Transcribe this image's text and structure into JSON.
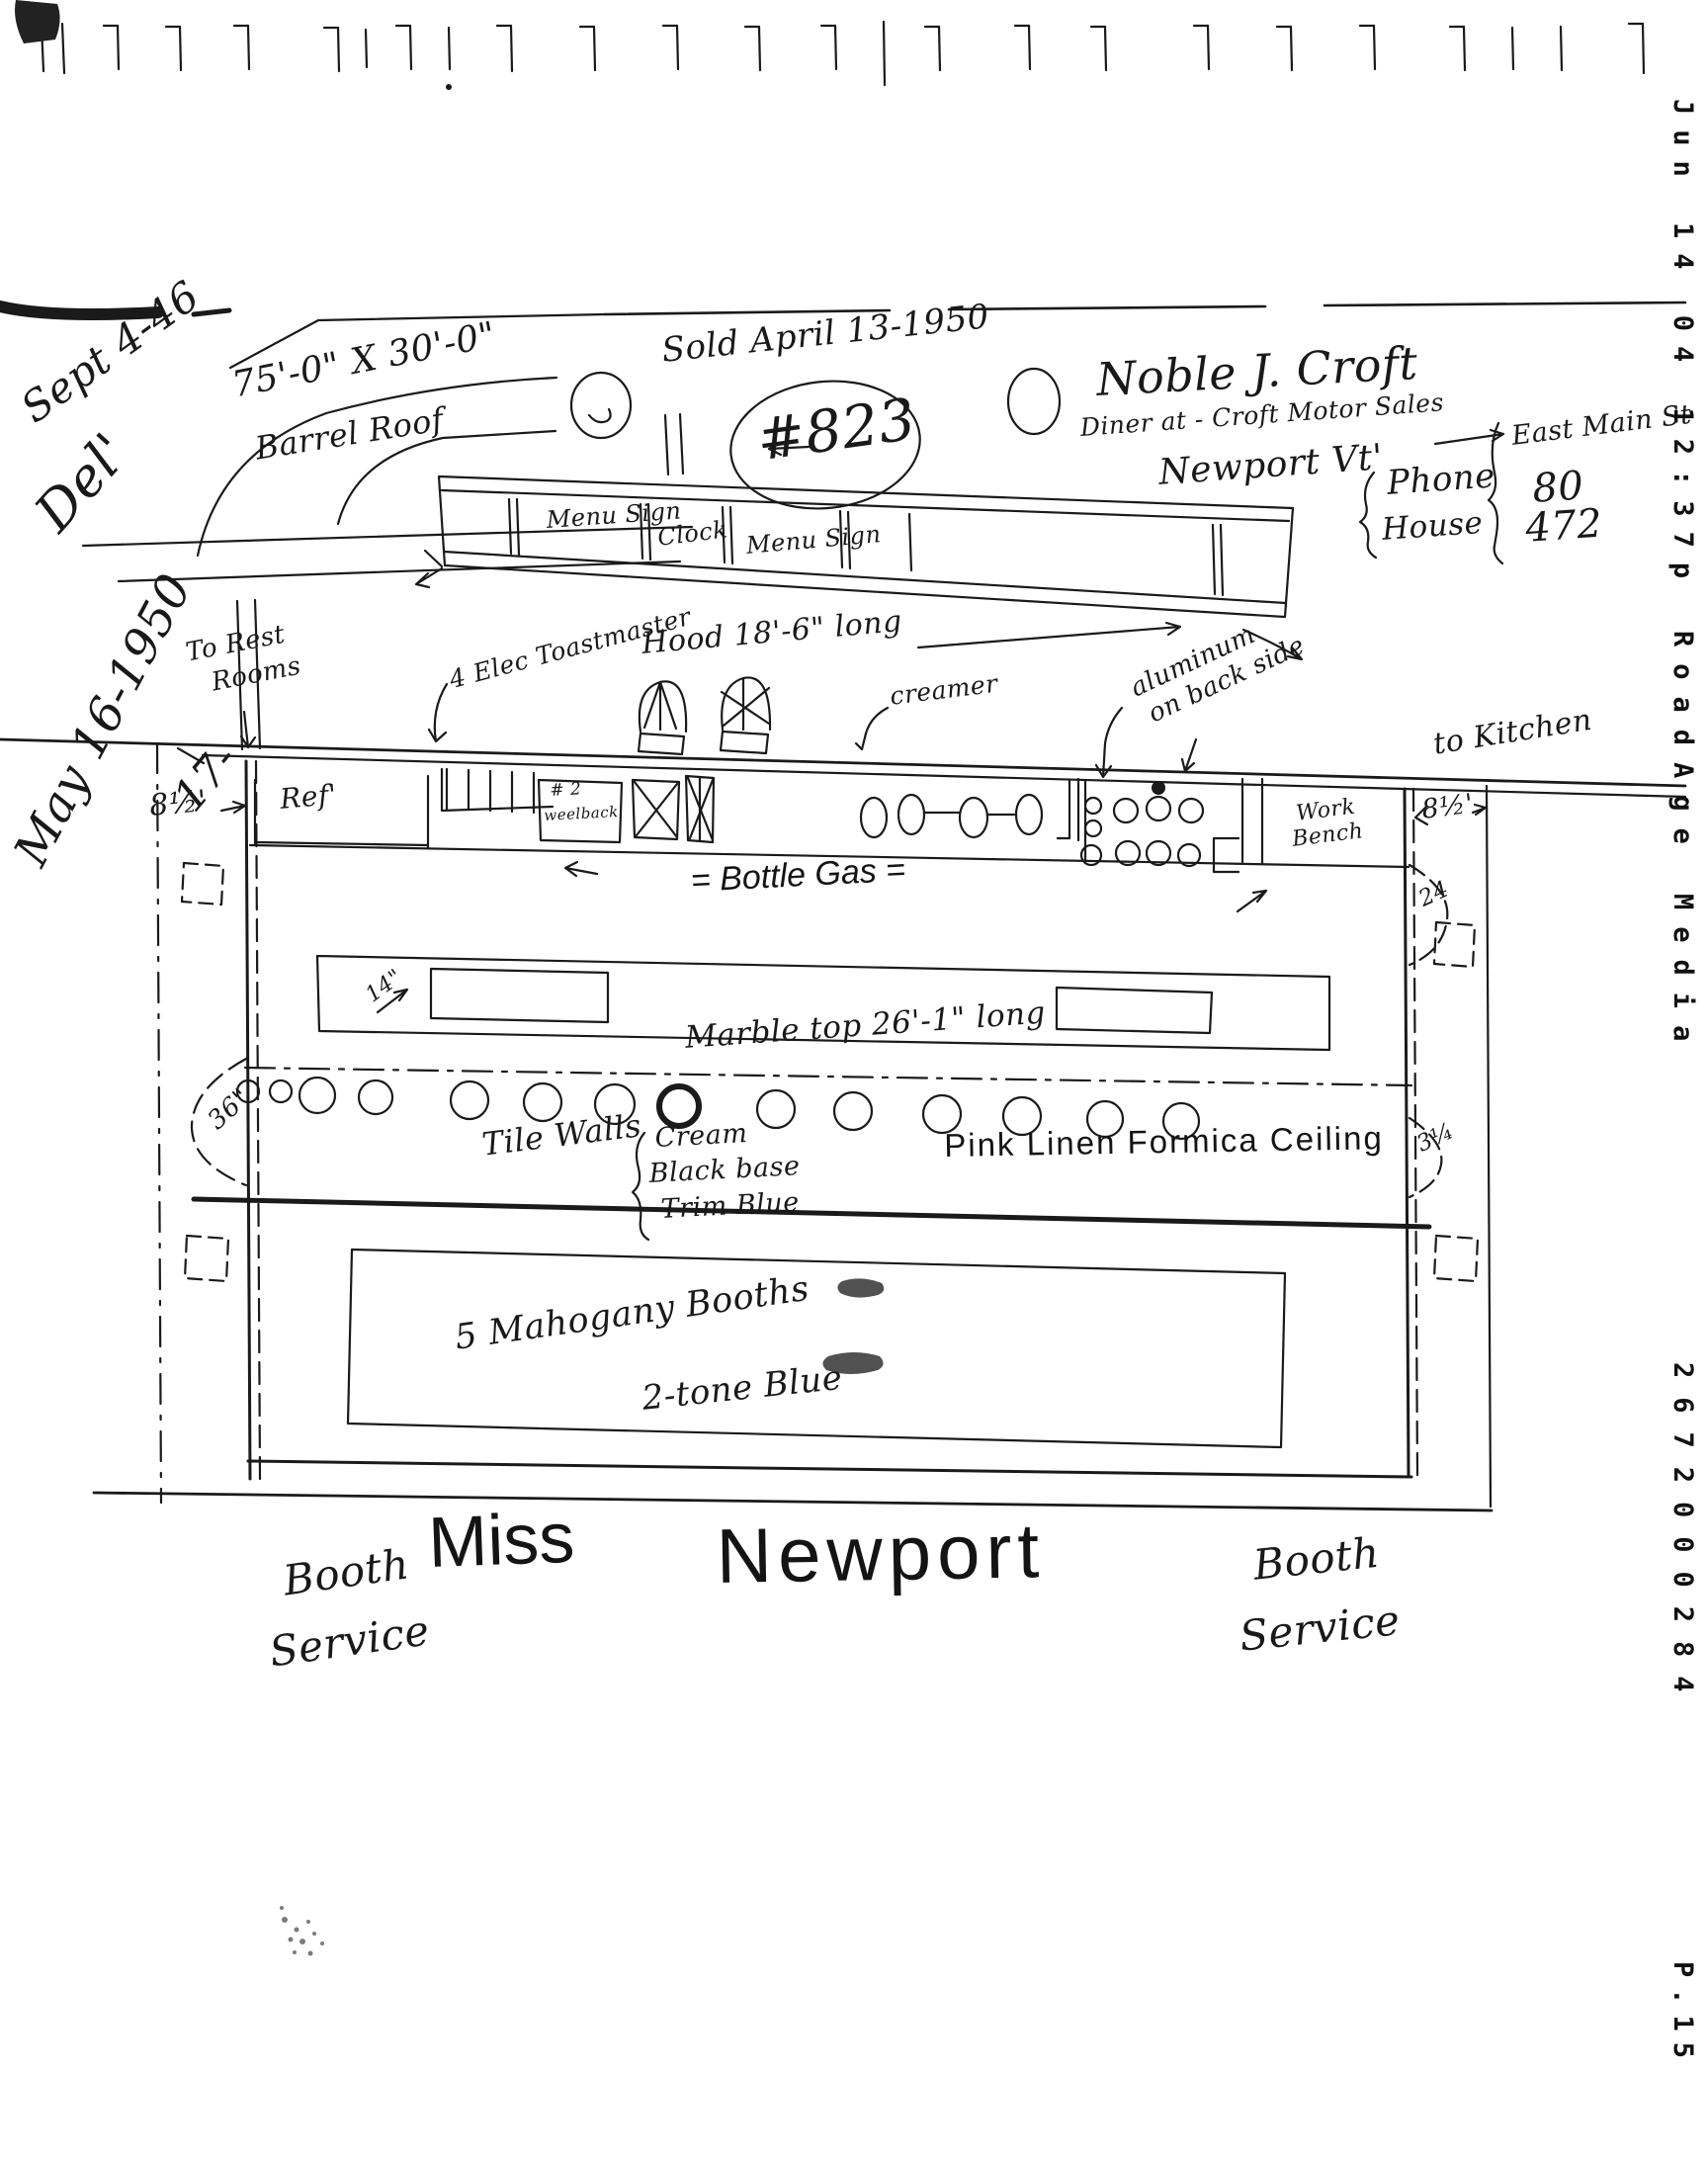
{
  "fax": {
    "datetime": "Jun 14 04 12:37p",
    "station": "RoadAge Media",
    "number": "2672000284",
    "page": "P.15"
  },
  "notes": {
    "top_left_date": "Sept 4-46",
    "del": "Del'",
    "may_date": "May 16-1950",
    "seventeen": "17-",
    "size": "75'-0\" X 30'-0\"",
    "roof": "Barrel Roof",
    "sold": "Sold April 13-1950",
    "car_number": "#823",
    "owner_name": "Noble J. Croft",
    "owner_line": "Diner at - Croft Motor Sales",
    "address": "East Main St",
    "city": "Newport Vt'",
    "phone_label": "Phone",
    "phone": "80",
    "house_label": "House",
    "house": "472"
  },
  "hood": {
    "panel_left": "Menu Sign",
    "panel_center": "Clock",
    "panel_right": "Menu Sign",
    "length": "Hood 18'-6\" long"
  },
  "plan": {
    "toastmaster": "4 Elec Toastmaster",
    "rest_rooms_1": "To Rest",
    "rest_rooms_2": "Rooms",
    "creamer": "creamer",
    "aluminum_1": "aluminum",
    "aluminum_2": "on back side",
    "kitchen": "to Kitchen",
    "ref": "Ref'",
    "weelback_1": "# 2",
    "weelback_2": "weelback",
    "bottle_gas": "= Bottle Gas =",
    "work_1": "Work",
    "work_2": "Bench",
    "marble": "Marble top 26'-1\" long",
    "tile_walls": "Tile Walls",
    "tile_1": "Cream",
    "tile_2": "Black base",
    "tile_3": "Trim Blue",
    "ceiling": "Pink Linen Formica Ceiling",
    "booths_1": "5 Mahogany Booths",
    "booths_2": "2-tone Blue",
    "dim_left": "8½'",
    "dim_right": "8½'",
    "dim_24": "24",
    "dim_36": "36\"",
    "dim_3q": "3¼",
    "dim_14": "14\""
  },
  "footer": {
    "booth_left_1": "Booth",
    "booth_left_2": "Service",
    "miss": "Miss",
    "newport": "Newport",
    "booth_right_1": "Booth",
    "booth_right_2": "Service"
  },
  "ink_color": "#1a1a1a"
}
